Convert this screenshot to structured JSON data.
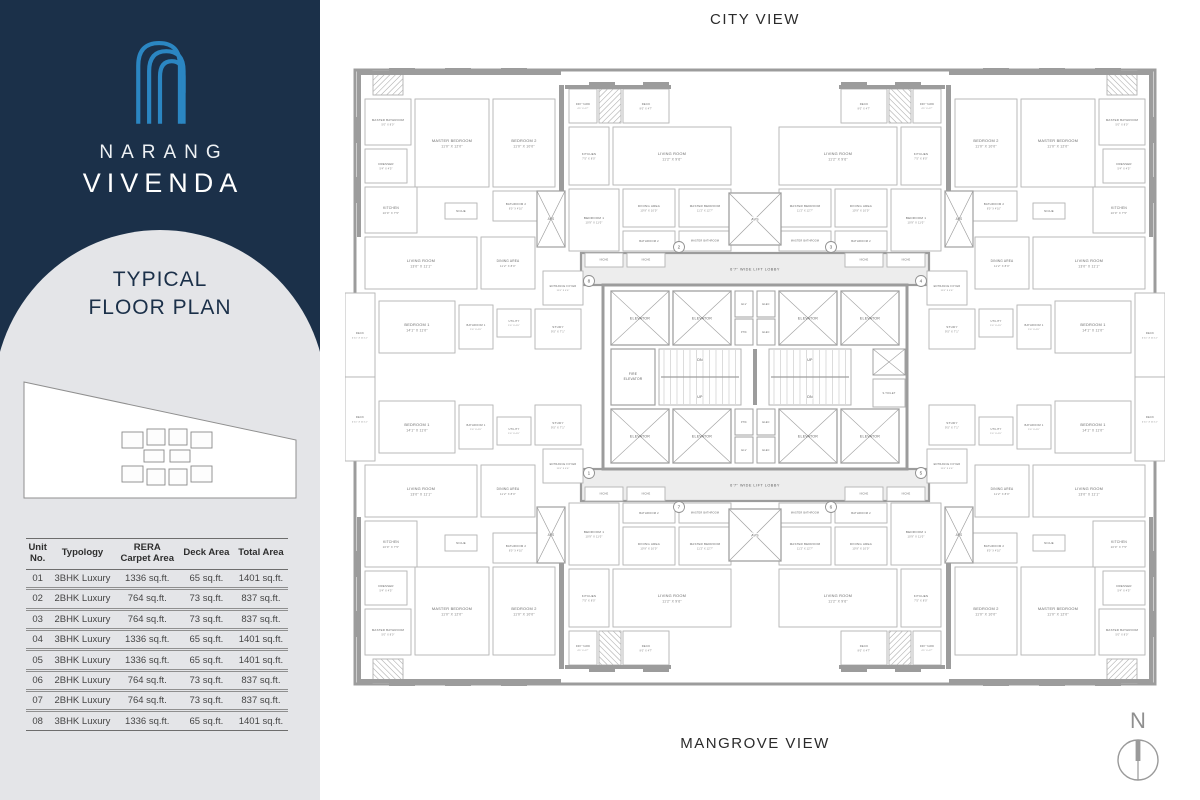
{
  "brand": {
    "line1": "NARANG",
    "line2": "VIVENDA",
    "logo_color": "#2b86c2"
  },
  "panel": {
    "title_line1": "TYPICAL",
    "title_line2": "FLOOR PLAN"
  },
  "table": {
    "headers": [
      "Unit\nNo.",
      "Typology",
      "RERA\nCarpet Area",
      "Deck Area",
      "Total Area"
    ],
    "rows": [
      [
        "01",
        "3BHK Luxury",
        "1336 sq.ft.",
        "65 sq.ft.",
        "1401 sq.ft."
      ],
      [
        "02",
        "2BHK Luxury",
        "764 sq.ft.",
        "73 sq.ft.",
        "837 sq.ft."
      ],
      [
        "03",
        "2BHK Luxury",
        "764 sq.ft.",
        "73 sq.ft.",
        "837 sq.ft."
      ],
      [
        "04",
        "3BHK Luxury",
        "1336 sq.ft.",
        "65 sq.ft.",
        "1401 sq.ft."
      ],
      [
        "05",
        "3BHK Luxury",
        "1336 sq.ft.",
        "65 sq.ft.",
        "1401 sq.ft."
      ],
      [
        "06",
        "2BHK Luxury",
        "764 sq.ft.",
        "73 sq.ft.",
        "837 sq.ft."
      ],
      [
        "07",
        "2BHK Luxury",
        "764 sq.ft.",
        "73 sq.ft.",
        "837 sq.ft."
      ],
      [
        "08",
        "3BHK Luxury",
        "1336 sq.ft.",
        "65 sq.ft.",
        "1401 sq.ft."
      ]
    ]
  },
  "plan": {
    "view_top": "CITY VIEW",
    "view_bottom": "MANGROVE VIEW",
    "north_label": "N",
    "lobby_label": "6'7\" WIDE LIFT LOBBY",
    "colors": {
      "wall": "#9c9c9c",
      "stroke": "#b3b3b3",
      "label": "#6a6a6a",
      "dims": "#7d7d7d",
      "lobby": "#ededed",
      "shaft": "#a0a0a0"
    },
    "quadrants": [
      {
        "id": "top-left",
        "mx": 0,
        "my": 0,
        "corner_no": "8",
        "inner_no": "2"
      },
      {
        "id": "top-right",
        "mx": 1,
        "my": 0,
        "corner_no": "4",
        "inner_no": "3"
      },
      {
        "id": "bottom-left",
        "mx": 0,
        "my": 1,
        "corner_no": "1",
        "inner_no": "7"
      },
      {
        "id": "bottom-right",
        "mx": 1,
        "my": 1,
        "corner_no": "5",
        "inner_no": "6"
      }
    ],
    "circle_positions": {
      "corner": [
        244,
        224
      ],
      "inner": [
        334,
        190
      ]
    },
    "rooms": [
      {
        "t": "hatch",
        "b": [
          28,
          14,
          30,
          24
        ]
      },
      {
        "n": "MASTER BATHROOM",
        "d": "5'0\" X 8'0\"",
        "b": [
          20,
          42,
          46,
          46
        ],
        "fs": 2.9
      },
      {
        "n": "DRESSER",
        "d": "5'4\" X 4'5\"",
        "b": [
          20,
          92,
          42,
          34
        ],
        "fs": 2.9
      },
      {
        "n": "MASTER BEDROOM",
        "d": "11'0\" X 12'0\"",
        "b": [
          70,
          42,
          74,
          88
        ]
      },
      {
        "n": "BEDROOM 2",
        "d": "11'0\" X 10'0\"",
        "b": [
          148,
          42,
          62,
          88
        ]
      },
      {
        "n": "BATHROOM 2",
        "d": "8'0\" X 4'10\"",
        "b": [
          148,
          134,
          46,
          30
        ],
        "fs": 2.8
      },
      {
        "n": "KITCHEN",
        "d": "10'0\" X 7'5\"",
        "b": [
          20,
          130,
          52,
          46
        ],
        "fs": 3.3
      },
      {
        "n": "NICHE",
        "b": [
          100,
          146,
          32,
          16
        ],
        "fs": 2.8
      },
      {
        "n": "LIVING ROOM",
        "d": "13'0\" X 11'1\"",
        "b": [
          20,
          180,
          112,
          52
        ]
      },
      {
        "n": "DINING AREA",
        "d": "11'2\" X 8'0\"",
        "b": [
          136,
          180,
          54,
          52
        ],
        "fs": 3.2
      },
      {
        "n": "DECK",
        "d": "4'11\" X 11'11\"",
        "b": [
          0,
          236,
          30,
          84
        ],
        "fs": 2.7
      },
      {
        "n": "BEDROOM 1",
        "d": "14'1\" X 11'0\"",
        "b": [
          34,
          244,
          76,
          52
        ]
      },
      {
        "n": "BATHROOM 1",
        "d": "5'0\" X 4'0\"",
        "b": [
          114,
          248,
          34,
          44
        ],
        "fs": 2.6
      },
      {
        "n": "UTILITY",
        "d": "5'0\" X 4'0\"",
        "b": [
          152,
          252,
          34,
          28
        ],
        "fs": 2.6
      },
      {
        "n": "STUDY",
        "d": "9'5\" X 7'1\"",
        "b": [
          190,
          252,
          46,
          40
        ],
        "fs": 3.1
      },
      {
        "n": "ENTRANCE FOYER",
        "d": "11'0\" X 4'6\"",
        "b": [
          198,
          214,
          40,
          34
        ],
        "fs": 2.6
      },
      {
        "n": "AVS",
        "t": "shaft",
        "b": [
          192,
          134,
          28,
          56
        ],
        "fs": 3.2
      },
      {
        "n": "DRY YARD",
        "d": "4'5\" X 4'7\"",
        "b": [
          224,
          32,
          28,
          34
        ],
        "fs": 2.5
      },
      {
        "t": "hatch",
        "b": [
          254,
          32,
          22,
          34
        ]
      },
      {
        "n": "DECK",
        "d": "8'0\" X 4'7\"",
        "b": [
          278,
          32,
          46,
          34
        ],
        "fs": 2.8
      },
      {
        "n": "KITCHEN",
        "d": "7'5\" X 8'0\"",
        "b": [
          224,
          70,
          40,
          58
        ],
        "fs": 3.0
      },
      {
        "n": "LIVING ROOM",
        "d": "11'2\" X 9'6\"",
        "b": [
          268,
          70,
          118,
          58
        ]
      },
      {
        "n": "BEDROOM 1",
        "d": "10'9\" X 11'0\"",
        "b": [
          224,
          132,
          50,
          62
        ],
        "fs": 3.1
      },
      {
        "n": "DINING AREA",
        "d": "10'9\" X 10'0\"",
        "b": [
          278,
          132,
          52,
          38
        ],
        "fs": 3.1
      },
      {
        "n": "BATHROOM 2",
        "b": [
          278,
          174,
          52,
          20
        ],
        "fs": 2.7
      },
      {
        "n": "MASTER BEDROOM",
        "d": "11'2\" X 12'7\"",
        "b": [
          334,
          132,
          52,
          38
        ],
        "fs": 2.9
      },
      {
        "n": "MASTER BATHROOM",
        "b": [
          334,
          174,
          52,
          20
        ],
        "fs": 2.5
      },
      {
        "n": "NICHE",
        "b": [
          240,
          196,
          38,
          14
        ],
        "fs": 2.5
      },
      {
        "n": "NICHE",
        "b": [
          282,
          196,
          38,
          14
        ],
        "fs": 2.5
      },
      {
        "t": "wall",
        "b": [
          12,
          14,
          204,
          4
        ]
      },
      {
        "t": "wall",
        "b": [
          220,
          28,
          106,
          4
        ]
      },
      {
        "t": "wall",
        "b": [
          12,
          14,
          4,
          166
        ]
      },
      {
        "t": "wall",
        "b": [
          214,
          28,
          5,
          106
        ]
      },
      {
        "t": "wall",
        "b": [
          44,
          11,
          26,
          7
        ]
      },
      {
        "t": "wall",
        "b": [
          100,
          11,
          26,
          7
        ]
      },
      {
        "t": "wall",
        "b": [
          156,
          11,
          26,
          7
        ]
      },
      {
        "t": "wall",
        "b": [
          244,
          25,
          26,
          7
        ]
      },
      {
        "t": "wall",
        "b": [
          298,
          25,
          26,
          7
        ]
      },
      {
        "t": "wall",
        "b": [
          9,
          60,
          7,
          26
        ]
      },
      {
        "t": "wall",
        "b": [
          9,
          120,
          7,
          26
        ]
      }
    ],
    "core": {
      "outline": [
        258,
        228,
        304,
        184
      ],
      "elevator_label": "ELEVATOR",
      "elevator_size": [
        58,
        54
      ],
      "elevators": [
        [
          266,
          234
        ],
        [
          328,
          234
        ],
        [
          434,
          234
        ],
        [
          496,
          234
        ],
        [
          266,
          352
        ],
        [
          328,
          352
        ],
        [
          434,
          352
        ],
        [
          496,
          352
        ]
      ],
      "shaft_size": [
        18,
        26
      ],
      "shafts_small": [
        {
          "label": "ELV",
          "x": 390,
          "y": 234
        },
        {
          "label": "PHC",
          "x": 390,
          "y": 262
        },
        {
          "label": "ELEC",
          "x": 412,
          "y": 234
        },
        {
          "label": "ELEC",
          "x": 412,
          "y": 262
        },
        {
          "label": "PHC",
          "x": 390,
          "y": 352
        },
        {
          "label": "ELV",
          "x": 390,
          "y": 380
        },
        {
          "label": "ELEC",
          "x": 412,
          "y": 352
        },
        {
          "label": "ELEC",
          "x": 412,
          "y": 380
        }
      ],
      "fire_elevator": {
        "label": "FIRE ELEVATOR",
        "x": 266,
        "y": 292,
        "w": 44,
        "h": 56
      },
      "stoilet": {
        "label": "S.TOILET",
        "x": 528,
        "y": 322,
        "w": 32,
        "h": 28
      },
      "xshaft": {
        "x": 528,
        "y": 292,
        "w": 32,
        "h": 26
      },
      "stairs": [
        {
          "x": 314,
          "y": 292,
          "w": 82,
          "h": 56,
          "top": "DN",
          "bottom": "UP"
        },
        {
          "x": 424,
          "y": 292,
          "w": 82,
          "h": 56,
          "top": "UP",
          "bottom": "DN"
        }
      ],
      "avs_label": "AVS",
      "avs_center": [
        [
          384,
          136
        ],
        [
          384,
          452
        ]
      ],
      "avs_size": [
        52,
        52
      ],
      "lobby_size": [
        348,
        32
      ],
      "lobbies": [
        [
          236,
          196
        ],
        [
          236,
          412
        ]
      ]
    }
  }
}
